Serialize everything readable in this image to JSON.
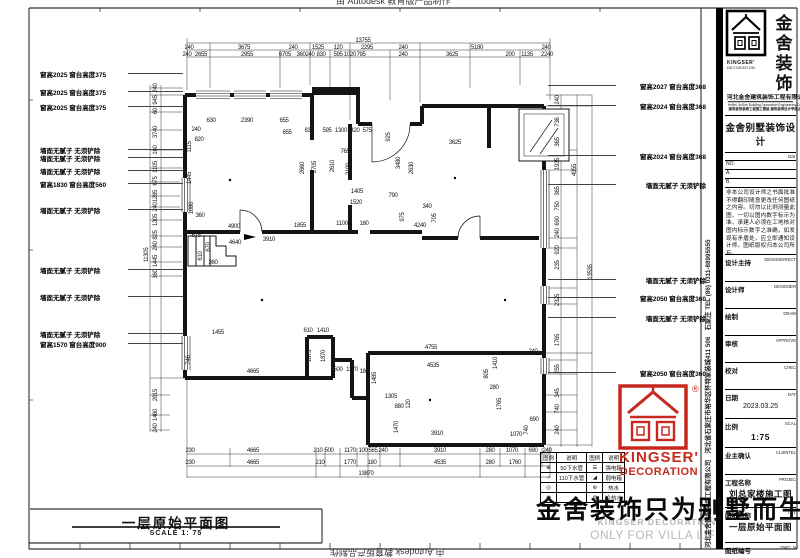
{
  "watermarks": {
    "autodesk": "由 Autodesk 教育版产品制作",
    "big_slogan": "金舍装饰只为别墅而生。",
    "grey_line1": "KINGSER'DECORATION",
    "grey_line2": "ONLY FOR VILLA LIFE"
  },
  "side_strip": {
    "text": "河北金舍建筑装饰工程有限公司　河北省石家庄市裕华区怀特家装城411 506　石家庄 TEL (86) 0311-88995555"
  },
  "stamp": {
    "reg": "®",
    "line1": "KINGSER'",
    "line2": "DECORATION"
  },
  "plan": {
    "title": "一层原始平面图",
    "scale": "SCALE 1: 75",
    "annotations_left": [
      {
        "y": 73,
        "t": "窗高2025 窗台高度375"
      },
      {
        "y": 91,
        "t": "窗高2025 窗台高度375"
      },
      {
        "y": 106,
        "t": "窗高2025 窗台高度375"
      },
      {
        "y": 149,
        "t": "墙面无腻子 无须铲除"
      },
      {
        "y": 157,
        "t": "墙面无腻子 无须铲除"
      },
      {
        "y": 170,
        "t": "墙面无腻子 无须铲除"
      },
      {
        "y": 183,
        "t": "窗高1830 窗台高度560"
      },
      {
        "y": 209,
        "t": "墙面无腻子 无须铲除"
      },
      {
        "y": 269,
        "t": "墙面无腻子 无须铲除"
      },
      {
        "y": 296,
        "t": "墙面无腻子 无须铲除"
      },
      {
        "y": 333,
        "t": "墙面无腻子 无须铲除"
      },
      {
        "y": 343,
        "t": "窗高1570 窗台高度900"
      }
    ],
    "annotations_right": [
      {
        "y": 85,
        "t": "窗高2027 窗台高度368"
      },
      {
        "y": 105,
        "t": "窗高2024 窗台高度368"
      },
      {
        "y": 155,
        "t": "窗高2024 窗台高度368"
      },
      {
        "y": 184,
        "t": "墙面无腻子 无须铲除"
      },
      {
        "y": 279,
        "t": "墙面无腻子 无须铲除"
      },
      {
        "y": 297,
        "t": "窗高2050 窗台高度360"
      },
      {
        "y": 317,
        "t": "墙面无腻子 无须铲除"
      },
      {
        "y": 372,
        "t": "窗高2050 窗台高度360"
      }
    ],
    "dim_labels": [
      {
        "x": 363,
        "y": 41,
        "t": "13755"
      },
      {
        "x": 189,
        "y": 48,
        "t": "240"
      },
      {
        "x": 244,
        "y": 48,
        "t": "3675"
      },
      {
        "x": 293,
        "y": 48,
        "t": "240"
      },
      {
        "x": 318,
        "y": 48,
        "t": "1525"
      },
      {
        "x": 338,
        "y": 48,
        "t": "120"
      },
      {
        "x": 367,
        "y": 48,
        "t": "2295"
      },
      {
        "x": 403,
        "y": 48,
        "t": "240"
      },
      {
        "x": 477,
        "y": 48,
        "t": "5180"
      },
      {
        "x": 546,
        "y": 48,
        "t": "240"
      },
      {
        "x": 187,
        "y": 55,
        "t": "240"
      },
      {
        "x": 201,
        "y": 55,
        "t": "2655"
      },
      {
        "x": 247,
        "y": 55,
        "t": "2955"
      },
      {
        "x": 285,
        "y": 55,
        "t": "6705"
      },
      {
        "x": 301,
        "y": 55,
        "t": "360"
      },
      {
        "x": 310,
        "y": 55,
        "t": "240"
      },
      {
        "x": 321,
        "y": 55,
        "t": "830"
      },
      {
        "x": 338,
        "y": 55,
        "t": "595"
      },
      {
        "x": 350,
        "y": 55,
        "t": "1020"
      },
      {
        "x": 361,
        "y": 55,
        "t": "795"
      },
      {
        "x": 403,
        "y": 55,
        "t": "240"
      },
      {
        "x": 452,
        "y": 55,
        "t": "3625"
      },
      {
        "x": 510,
        "y": 55,
        "t": "200"
      },
      {
        "x": 527,
        "y": 55,
        "t": "1135"
      },
      {
        "x": 547,
        "y": 55,
        "t": "2240"
      },
      {
        "x": 190,
        "y": 451,
        "t": "230"
      },
      {
        "x": 253,
        "y": 451,
        "t": "4665"
      },
      {
        "x": 318,
        "y": 451,
        "t": "210"
      },
      {
        "x": 329,
        "y": 451,
        "t": "500"
      },
      {
        "x": 350,
        "y": 451,
        "t": "1170"
      },
      {
        "x": 363,
        "y": 451,
        "t": "100"
      },
      {
        "x": 373,
        "y": 451,
        "t": "565"
      },
      {
        "x": 383,
        "y": 451,
        "t": "240"
      },
      {
        "x": 440,
        "y": 451,
        "t": "3910"
      },
      {
        "x": 490,
        "y": 451,
        "t": "280"
      },
      {
        "x": 512,
        "y": 451,
        "t": "1070"
      },
      {
        "x": 533,
        "y": 451,
        "t": "690"
      },
      {
        "x": 547,
        "y": 451,
        "t": "240"
      },
      {
        "x": 190,
        "y": 463,
        "t": "230"
      },
      {
        "x": 253,
        "y": 463,
        "t": "4665"
      },
      {
        "x": 320,
        "y": 463,
        "t": "210"
      },
      {
        "x": 350,
        "y": 463,
        "t": "1770"
      },
      {
        "x": 372,
        "y": 463,
        "t": "180"
      },
      {
        "x": 440,
        "y": 463,
        "t": "4535"
      },
      {
        "x": 490,
        "y": 463,
        "t": "280"
      },
      {
        "x": 515,
        "y": 463,
        "t": "1760"
      },
      {
        "x": 366,
        "y": 474,
        "t": "13870"
      },
      {
        "x": 147,
        "y": 255,
        "t": "11305",
        "r": 1
      },
      {
        "x": 156,
        "y": 88,
        "t": "240",
        "r": 1
      },
      {
        "x": 156,
        "y": 100,
        "t": "945",
        "r": 1
      },
      {
        "x": 156,
        "y": 111,
        "t": "60",
        "r": 1
      },
      {
        "x": 156,
        "y": 132,
        "t": "3740",
        "r": 1
      },
      {
        "x": 156,
        "y": 150,
        "t": "160",
        "r": 1
      },
      {
        "x": 156,
        "y": 167,
        "t": "1105",
        "r": 1
      },
      {
        "x": 156,
        "y": 181,
        "t": "675",
        "r": 1
      },
      {
        "x": 156,
        "y": 196,
        "t": "1285",
        "r": 1
      },
      {
        "x": 156,
        "y": 207,
        "t": "240",
        "r": 1
      },
      {
        "x": 156,
        "y": 220,
        "t": "1305",
        "r": 1
      },
      {
        "x": 156,
        "y": 235,
        "t": "825",
        "r": 1
      },
      {
        "x": 156,
        "y": 246,
        "t": "240",
        "r": 1
      },
      {
        "x": 156,
        "y": 261,
        "t": "1445",
        "r": 1
      },
      {
        "x": 156,
        "y": 274,
        "t": "160",
        "r": 1
      },
      {
        "x": 156,
        "y": 395,
        "t": "2815",
        "r": 1
      },
      {
        "x": 156,
        "y": 415,
        "t": "1460",
        "r": 1
      },
      {
        "x": 156,
        "y": 428,
        "t": "240",
        "r": 1
      },
      {
        "x": 558,
        "y": 100,
        "t": "240",
        "r": 1
      },
      {
        "x": 558,
        "y": 122,
        "t": "736",
        "r": 1
      },
      {
        "x": 558,
        "y": 142,
        "t": "365",
        "r": 1
      },
      {
        "x": 558,
        "y": 164,
        "t": "1935",
        "r": 1
      },
      {
        "x": 558,
        "y": 191,
        "t": "365",
        "r": 1
      },
      {
        "x": 558,
        "y": 206,
        "t": "750",
        "r": 1
      },
      {
        "x": 558,
        "y": 221,
        "t": "690",
        "r": 1
      },
      {
        "x": 558,
        "y": 233,
        "t": "240",
        "r": 1
      },
      {
        "x": 558,
        "y": 250,
        "t": "920",
        "r": 1
      },
      {
        "x": 558,
        "y": 265,
        "t": "235",
        "r": 1
      },
      {
        "x": 558,
        "y": 300,
        "t": "2325",
        "r": 1
      },
      {
        "x": 558,
        "y": 340,
        "t": "1765",
        "r": 1
      },
      {
        "x": 558,
        "y": 369,
        "t": "255",
        "r": 1
      },
      {
        "x": 558,
        "y": 393,
        "t": "345",
        "r": 1
      },
      {
        "x": 558,
        "y": 409,
        "t": "740",
        "r": 1
      },
      {
        "x": 558,
        "y": 430,
        "t": "240",
        "r": 1
      },
      {
        "x": 575,
        "y": 170,
        "t": "4955",
        "r": 1
      },
      {
        "x": 591,
        "y": 272,
        "t": "13535",
        "r": 1
      },
      {
        "x": 211,
        "y": 121,
        "t": "630"
      },
      {
        "x": 247,
        "y": 121,
        "t": "2390"
      },
      {
        "x": 284,
        "y": 121,
        "t": "655"
      },
      {
        "x": 287,
        "y": 133,
        "t": "655"
      },
      {
        "x": 309,
        "y": 131,
        "t": "830"
      },
      {
        "x": 327,
        "y": 131,
        "t": "595"
      },
      {
        "x": 341,
        "y": 131,
        "t": "1300"
      },
      {
        "x": 355,
        "y": 131,
        "t": "420"
      },
      {
        "x": 367,
        "y": 131,
        "t": "575"
      },
      {
        "x": 190,
        "y": 147,
        "t": "1115",
        "r": 1
      },
      {
        "x": 199,
        "y": 140,
        "t": "820"
      },
      {
        "x": 196,
        "y": 130,
        "t": "240"
      },
      {
        "x": 303,
        "y": 168,
        "t": "2660",
        "r": 1
      },
      {
        "x": 315,
        "y": 167,
        "t": "2705",
        "r": 1
      },
      {
        "x": 333,
        "y": 166,
        "t": "2610",
        "r": 1
      },
      {
        "x": 349,
        "y": 169,
        "t": "2100",
        "r": 1
      },
      {
        "x": 345,
        "y": 152,
        "t": "765"
      },
      {
        "x": 357,
        "y": 192,
        "t": "1405"
      },
      {
        "x": 356,
        "y": 203,
        "t": "1520"
      },
      {
        "x": 190,
        "y": 178,
        "t": "1445",
        "r": 1
      },
      {
        "x": 192,
        "y": 208,
        "t": "1080",
        "r": 1
      },
      {
        "x": 200,
        "y": 216,
        "t": "360"
      },
      {
        "x": 234,
        "y": 227,
        "t": "4900"
      },
      {
        "x": 300,
        "y": 226,
        "t": "1855"
      },
      {
        "x": 342,
        "y": 224,
        "t": "1100"
      },
      {
        "x": 364,
        "y": 224,
        "t": "180"
      },
      {
        "x": 235,
        "y": 243,
        "t": "4640"
      },
      {
        "x": 269,
        "y": 240,
        "t": "3910"
      },
      {
        "x": 455,
        "y": 143,
        "t": "3625"
      },
      {
        "x": 399,
        "y": 163,
        "t": "3480",
        "r": 1
      },
      {
        "x": 412,
        "y": 168,
        "t": "2630",
        "r": 1
      },
      {
        "x": 389,
        "y": 137,
        "t": "925",
        "r": 1
      },
      {
        "x": 393,
        "y": 196,
        "t": "790"
      },
      {
        "x": 403,
        "y": 217,
        "t": "975",
        "r": 1
      },
      {
        "x": 420,
        "y": 226,
        "t": "4240"
      },
      {
        "x": 427,
        "y": 207,
        "t": "340"
      },
      {
        "x": 435,
        "y": 218,
        "t": "705",
        "r": 1
      },
      {
        "x": 431,
        "y": 348,
        "t": "4755"
      },
      {
        "x": 433,
        "y": 366,
        "t": "4535"
      },
      {
        "x": 496,
        "y": 363,
        "t": "1410",
        "r": 1
      },
      {
        "x": 487,
        "y": 374,
        "t": "805",
        "r": 1
      },
      {
        "x": 375,
        "y": 378,
        "t": "1485",
        "r": 1
      },
      {
        "x": 352,
        "y": 370,
        "t": "1170"
      },
      {
        "x": 338,
        "y": 370,
        "t": "500"
      },
      {
        "x": 364,
        "y": 372,
        "t": "180"
      },
      {
        "x": 391,
        "y": 397,
        "t": "1305"
      },
      {
        "x": 399,
        "y": 407,
        "t": "880"
      },
      {
        "x": 409,
        "y": 404,
        "t": "120",
        "r": 1
      },
      {
        "x": 397,
        "y": 427,
        "t": "1470",
        "r": 1
      },
      {
        "x": 310,
        "y": 356,
        "t": "1875",
        "r": 1
      },
      {
        "x": 324,
        "y": 356,
        "t": "1870",
        "r": 1
      },
      {
        "x": 253,
        "y": 372,
        "t": "4665"
      },
      {
        "x": 218,
        "y": 333,
        "t": "1455"
      },
      {
        "x": 308,
        "y": 331,
        "t": "610"
      },
      {
        "x": 323,
        "y": 331,
        "t": "1410"
      },
      {
        "x": 437,
        "y": 434,
        "t": "3910"
      },
      {
        "x": 500,
        "y": 404,
        "t": "1765",
        "r": 1
      },
      {
        "x": 494,
        "y": 388,
        "t": "280"
      },
      {
        "x": 516,
        "y": 435,
        "t": "1070"
      },
      {
        "x": 534,
        "y": 420,
        "t": "690"
      },
      {
        "x": 527,
        "y": 430,
        "t": "740",
        "r": 1
      },
      {
        "x": 196,
        "y": 236,
        "t": "675"
      },
      {
        "x": 209,
        "y": 247,
        "t": "670",
        "r": 1
      },
      {
        "x": 201,
        "y": 256,
        "t": "610",
        "r": 1
      },
      {
        "x": 213,
        "y": 263,
        "t": "360"
      },
      {
        "x": 189,
        "y": 360,
        "t": "746",
        "r": 1
      },
      {
        "x": 533,
        "y": 352,
        "t": "240"
      }
    ]
  },
  "legend": {
    "headers": [
      "图例",
      "说明",
      "图例",
      "说明"
    ],
    "rows": [
      {
        "s1": "⊕",
        "d1": "50下水管",
        "s2": "☰",
        "d2": "强电箱"
      },
      {
        "s1": "○",
        "d1": "110下水管",
        "s2": "◢",
        "d2": "弱电箱"
      },
      {
        "s1": "◎",
        "d1": "",
        "s2": "⊛",
        "d2": "热水"
      },
      {
        "s1": "◉",
        "d1": "",
        "s2": "⊚",
        "d2": "冷热水"
      }
    ]
  },
  "titleblock": {
    "logo_cn1": "金舍",
    "logo_cn2": "装饰",
    "logo_en1": "KINGSER'",
    "logo_en2": "DECORATION",
    "company": "河北金舍建筑装饰工程有限公司",
    "company_en": "HeBei JinShe Building Decoration Engineering Co., Ltd.",
    "company_sub": "建筑装饰装修工程施工壹级 建筑装饰设计甲级企业",
    "brand": "金舍别墅装饰设计",
    "dat_label": "Dat",
    "no_label": "NO.",
    "a_label": "A.",
    "b_label": "B.",
    "note": "非本公司设计师之书面批准 不得翻印随意更改任何图纸之内容。切勿以比例测量此图，一切以图内数字标示为准。承建人必须在工地核对图内标示数字之准确，如发现有矛盾处，应立即通知设计师。图纸版权归本公司所有。",
    "fields": [
      {
        "cn": "设计主持",
        "en": "DESIGNDIRECT",
        "v": ""
      },
      {
        "cn": "设计师",
        "en": "DESIGNER",
        "v": ""
      },
      {
        "cn": "绘制",
        "en": "DRAW",
        "v": ""
      },
      {
        "cn": "审核",
        "en": "APPROVE",
        "v": ""
      },
      {
        "cn": "校对",
        "en": "CHEC",
        "v": ""
      },
      {
        "cn": "日期",
        "en": "DAT",
        "v": "2023.03.25",
        "emph": false
      },
      {
        "cn": "比例",
        "en": "SCAL",
        "v": "1:75",
        "emph": true
      },
      {
        "cn": "业主确认",
        "en": "CLIENTEL",
        "v": ""
      },
      {
        "cn": "工程名称",
        "en": "PROJEC",
        "v": "刘总家楼施工图",
        "emph": true
      },
      {
        "cn": "图纸名称",
        "en": "TITL",
        "v": "一层原始平面图",
        "emph": true
      },
      {
        "cn": "图纸编号",
        "en": "DWG. N",
        "v": "ZS-01",
        "emph": true
      }
    ]
  }
}
